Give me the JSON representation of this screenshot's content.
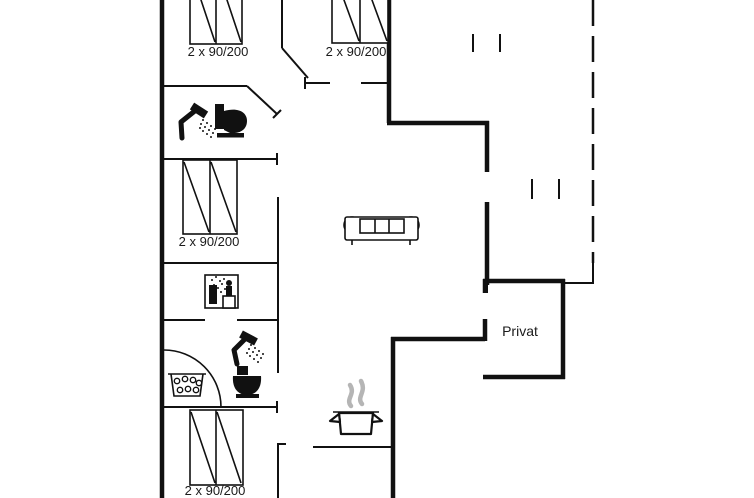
{
  "floorplan": {
    "colors": {
      "background": "#ffffff",
      "line": "#111111",
      "steam": "#b5b5b5"
    },
    "bedrooms": [
      {
        "id": "bedroom-top-left",
        "bed_label": "2 x 90/200"
      },
      {
        "id": "bedroom-top-right",
        "bed_label": "2 x 90/200"
      },
      {
        "id": "bedroom-middle-left",
        "bed_label": "2 x 90/200"
      },
      {
        "id": "bedroom-bottom-left",
        "bed_label": "2 x 90/200"
      }
    ],
    "rooms": {
      "private_room_label": "Privat"
    },
    "fixtures": [
      "double-bed-icon",
      "shower-icon",
      "toilet-icon",
      "sauna-icon",
      "whirlpool-icon",
      "cooking-pot-icon",
      "sofa-icon"
    ]
  }
}
